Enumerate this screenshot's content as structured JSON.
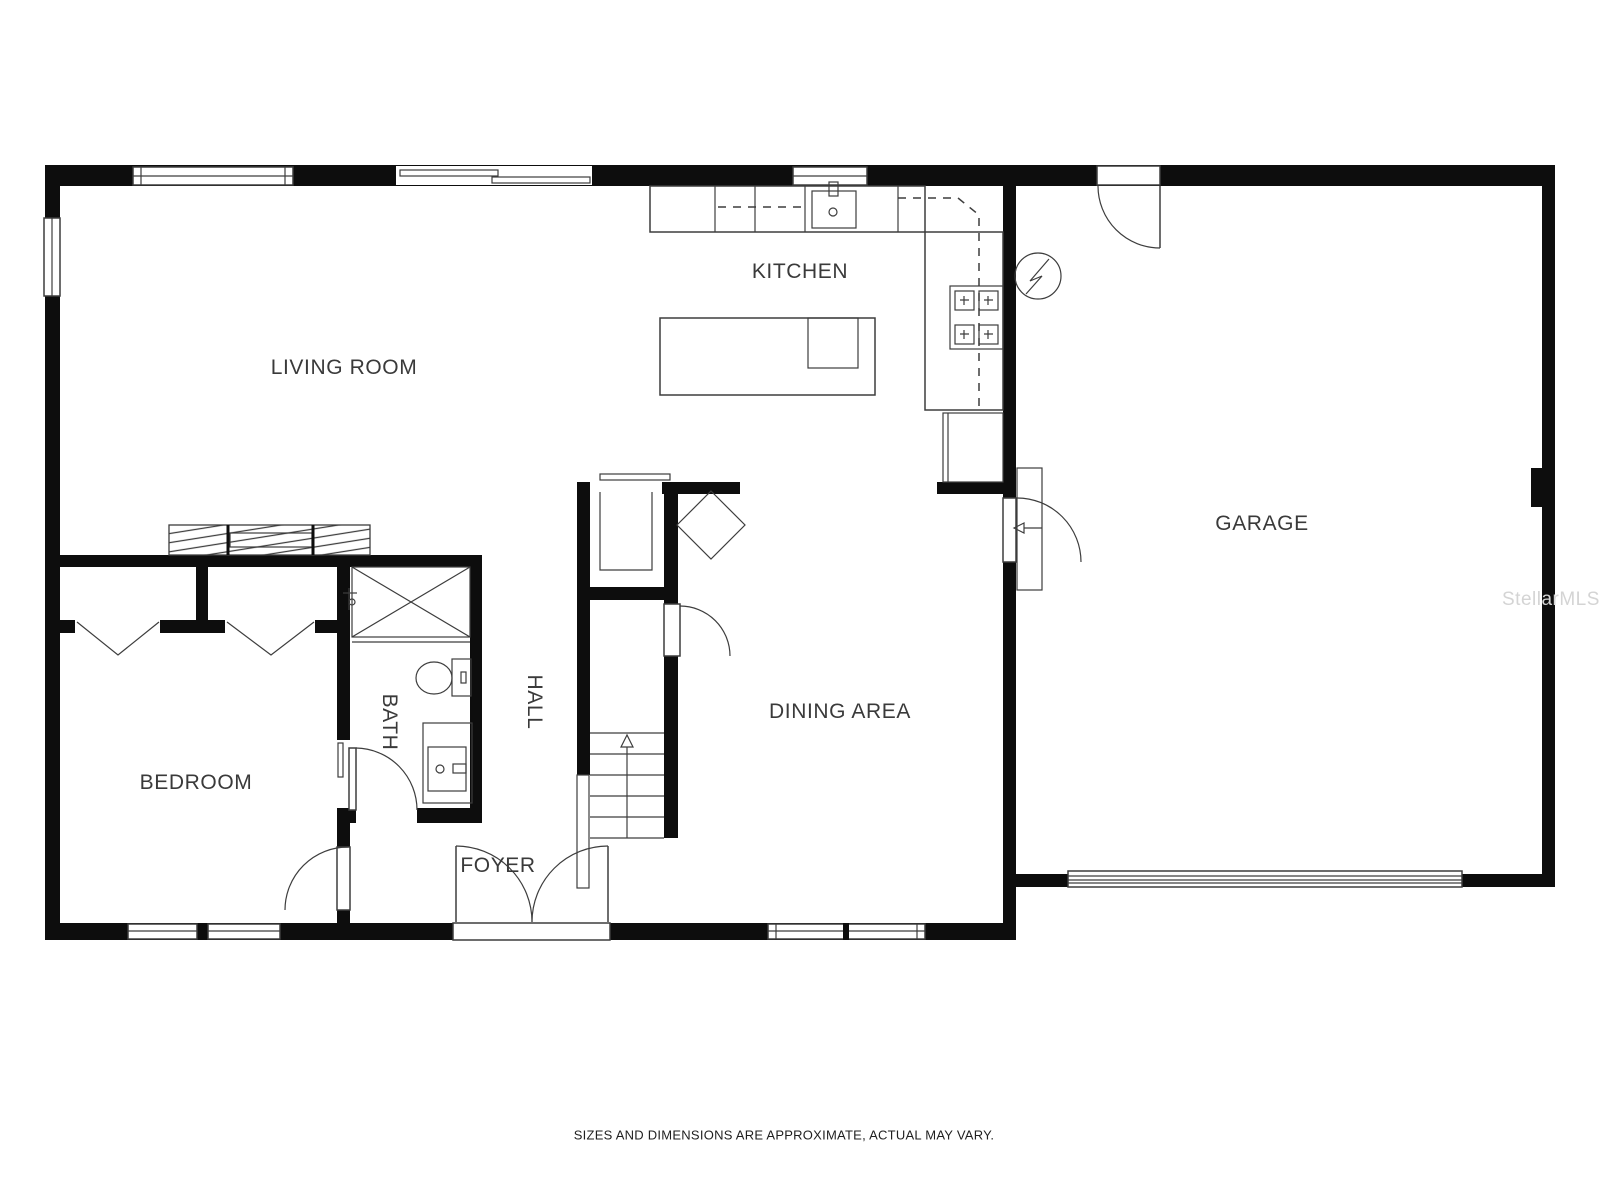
{
  "labels": {
    "living_room": "LIVING ROOM",
    "kitchen": "KITCHEN",
    "garage": "GARAGE",
    "dining_area": "DINING AREA",
    "bedroom": "BEDROOM",
    "foyer": "FOYER",
    "bath": "BATH",
    "hall": "HALL"
  },
  "watermark": "StellarMLS",
  "disclaimer": "SIZES AND DIMENSIONS ARE APPROXIMATE, ACTUAL MAY VARY.",
  "icons": {
    "stairs_direction": "up-arrow",
    "electrical_panel": "lightning-bolt-circle"
  },
  "colors": {
    "wall": "#0d0d0d",
    "line": "#3d3d3d",
    "text": "#3a3a3a",
    "watermark": "#d4d4d4"
  }
}
